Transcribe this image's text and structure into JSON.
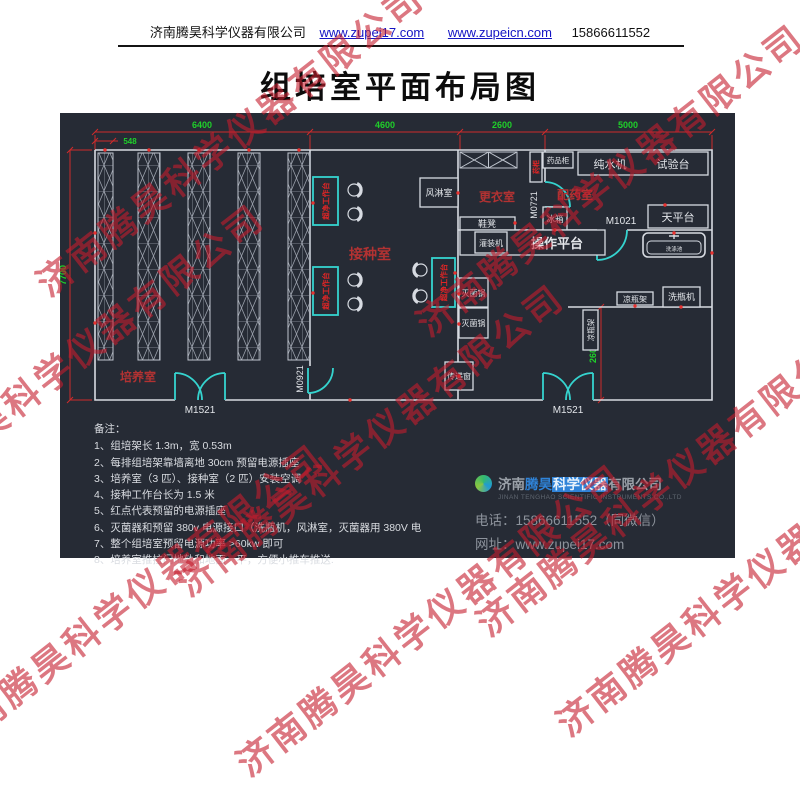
{
  "header": {
    "company": "济南腾昊科学仪器有限公司",
    "link1": "www.zupei17.com",
    "link2": "www.zupeicn.com",
    "phone": "15866611552"
  },
  "title": "组培室平面布局图",
  "watermark": {
    "text": "济南腾昊科学仪器有限公司",
    "color": "#c41c2d"
  },
  "plan": {
    "dims": {
      "d6400": "6400",
      "d4600": "4600",
      "d2600_top": "2600",
      "d5000": "5000",
      "d548": "548",
      "d7700": "7700",
      "d2600_right": "2600"
    },
    "rooms": {
      "culture": "培养室",
      "inoculation": "接种室",
      "changing": "更衣室",
      "dispensing": "配药室"
    },
    "doors": {
      "m1521": "M1521",
      "m0921": "M0921",
      "m0721": "M0721",
      "m1021": "M1021"
    },
    "equipment": {
      "air_shower": "风淋室",
      "medicine_cabinet": "药品柜",
      "small_cabinet": "药柜",
      "water_purifier": "纯水机",
      "test_bench": "试验台",
      "shoe_bench": "鞋凳",
      "fridge": "冰箱",
      "balance": "天平台",
      "filling_machine": "灌装机",
      "operation_platform": "操作平台",
      "sterilizer": "灭菌锅",
      "pass_window": "传递窗",
      "cooling_rack": "凉瓶架",
      "bottle_washer": "洗瓶机",
      "sink": "洗涤池",
      "clean_bench": "超净工作台"
    },
    "colors": {
      "background": "#262b35",
      "wall": "#d7dbe2",
      "door": "#35d4cf",
      "dimension_text": "#1fd02a",
      "dimension_line": "#cf2b2b",
      "room_label": "#b23232",
      "outlet_dot": "#e8312f"
    }
  },
  "notes": {
    "heading": "备注：",
    "items": [
      "1、组培架长 1.3m，宽 0.53m",
      "2、每排组培架靠墙离地 30cm 预留电源插座",
      "3、培养室（3 匹）、接种室（2 匹）安装空调",
      "4、接种工作台长为 1.5 米",
      "5、红点代表预留的电源插座",
      "6、灭菌器和预留 380v 电源接口（洗瓶机，风淋室，灭菌器用 380V 电",
      "7、整个组培室预留电源功率 >60kw 即可",
      "8、培养室推拉门地轨和地面一平，方便小推车推送."
    ]
  },
  "footer": {
    "company_pre": "济南",
    "company_mid": "腾昊",
    "company_hl": "科学仪器",
    "company_post": "有限公司",
    "company_en": "JINAN TENGHAO SCIENTIFIC INSTRUMENTS CO.,LTD",
    "phone_label": "电话：",
    "phone": "15866611552（同微信）",
    "web_label": "网址：",
    "web": "www.zupei17.com"
  }
}
